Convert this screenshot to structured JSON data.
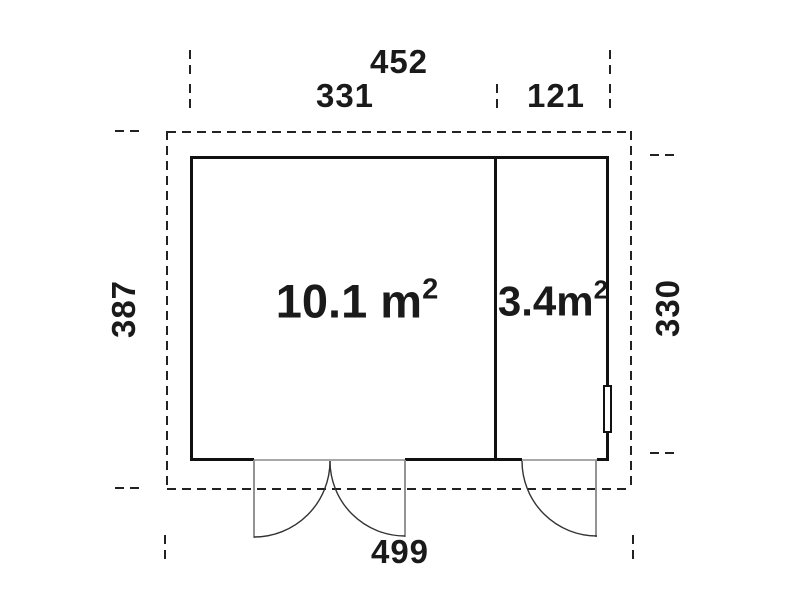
{
  "diagram": {
    "type": "floor-plan",
    "dimensions_cm": {
      "top_total": "452",
      "top_left_section": "331",
      "top_right_section": "121",
      "left_side": "387",
      "right_side": "330",
      "bottom_total": "499"
    },
    "rooms": [
      {
        "name": "main-room",
        "area": "10.1 m",
        "area_superscript": "2"
      },
      {
        "name": "side-room",
        "area": "3.4m",
        "area_superscript": "2"
      }
    ],
    "glyphs": {
      "double_door": "double-door-swing",
      "single_door": "single-door-swing",
      "window": "window-mark"
    },
    "colors": {
      "wall": "#111111",
      "boundary": "#222222",
      "door_leaf": "#949494",
      "swing_arc": "#333333",
      "text": "#1a1a1a",
      "background": "#ffffff"
    }
  }
}
